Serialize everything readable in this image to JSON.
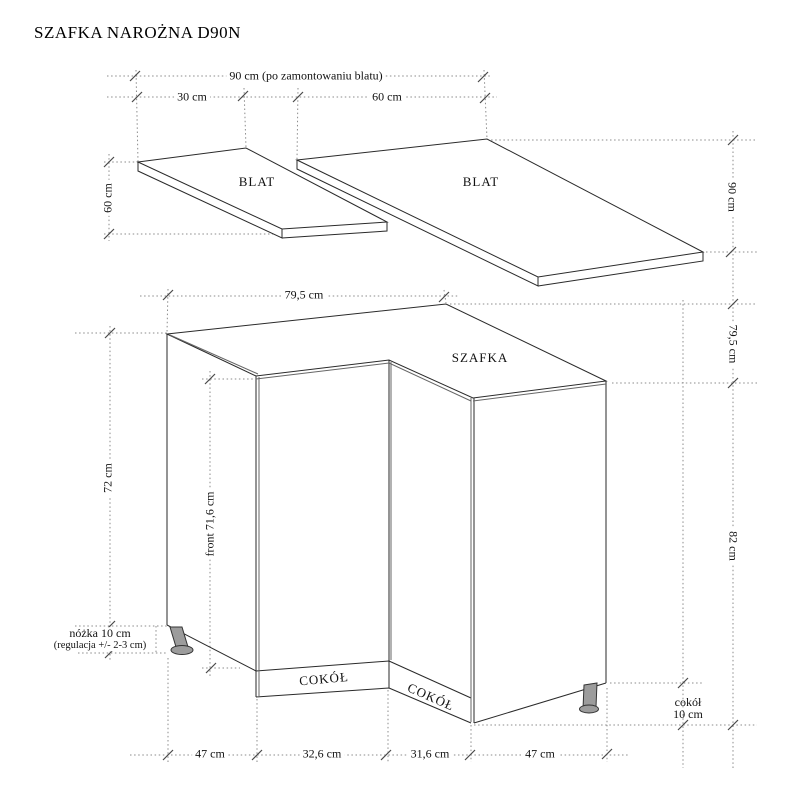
{
  "title": "SZAFKA NAROŻNA D90N",
  "top_view": {
    "dim_total": "90 cm (po zamontowaniu blatu)",
    "dim_left_width": "30 cm",
    "dim_right_width": "60 cm",
    "dim_left_depth": "60 cm",
    "dim_right_depth": "90 cm",
    "left_label": "BLAT",
    "right_label": "BLAT"
  },
  "cabinet": {
    "label": "SZAFKA",
    "dim_top_width": "79,5 cm",
    "dim_right_depth": "79,5 cm",
    "dim_height_left": "72 cm",
    "dim_front_height": "front 71,6 cm",
    "dim_total_height": "82 cm",
    "leg_note_line1": "nóżka 10 cm",
    "leg_note_line2": "(regulacja +/- 2-3 cm)",
    "plinth_left_label": "COKÓŁ",
    "plinth_right_label": "COKÓŁ",
    "plinth_note_line1": "cokół",
    "plinth_note_line2": "10 cm",
    "dim_bottom": [
      "47 cm",
      "32,6 cm",
      "31,6 cm",
      "47 cm"
    ]
  },
  "colors": {
    "line": "#2a2a2a",
    "dim_line": "#8b8b8b",
    "tick": "#4a4a4a",
    "leg_fill": "#9c9c9c"
  }
}
